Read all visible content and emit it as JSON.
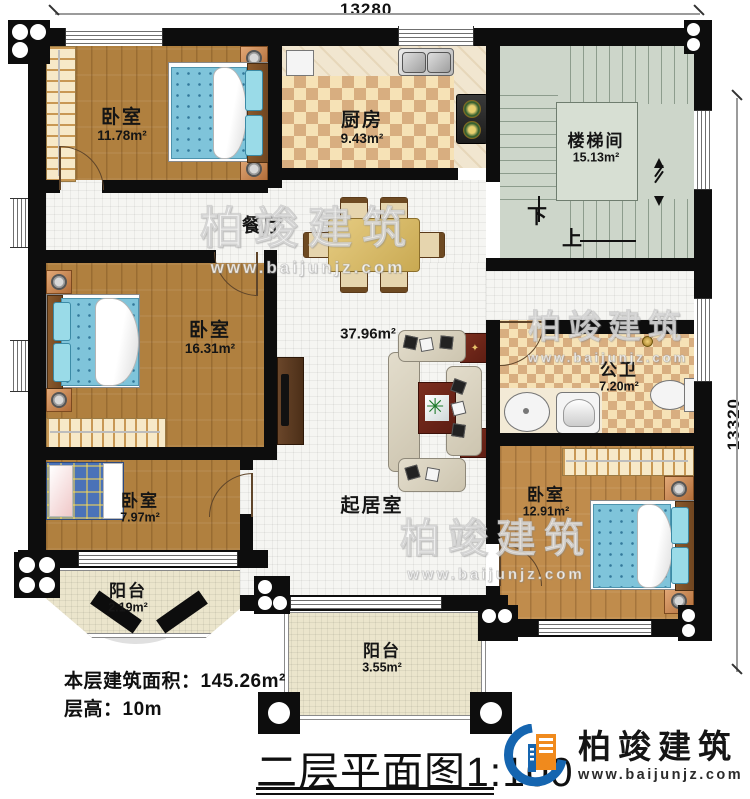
{
  "dimensions": {
    "top": "13280",
    "right": "13320"
  },
  "rooms": {
    "bedroom_top_left": {
      "name": "卧室",
      "area": "11.78m²"
    },
    "kitchen": {
      "name": "厨房",
      "area": "9.43m²"
    },
    "stairwell": {
      "name": "楼梯间",
      "area": "15.13m²"
    },
    "dining": {
      "name": "餐厅"
    },
    "bedroom_mid_left": {
      "name": "卧室",
      "area": "16.31m²"
    },
    "living": {
      "name": "起居室",
      "area": "37.96m²"
    },
    "bathroom": {
      "name": "公卫",
      "area": "7.20m²"
    },
    "bedroom_bottom_left": {
      "name": "卧室",
      "area": "7.97m²"
    },
    "bedroom_bottom_right": {
      "name": "卧室",
      "area": "12.91m²"
    },
    "balcony_left": {
      "name": "阳台",
      "area": "2.19m²"
    },
    "balcony_bottom": {
      "name": "阳台",
      "area": "3.55m²"
    }
  },
  "stairs": {
    "down_label": "下",
    "up_label": "上"
  },
  "notes": {
    "floor_area_label": "本层建筑面积：",
    "floor_area_value": "145.26m²",
    "floor_height_label": "层高：",
    "floor_height_value": "10m"
  },
  "title": {
    "text": "二层平面图",
    "scale": "1:100"
  },
  "branding": {
    "company": "柏竣建筑",
    "website": "www.baijunjz.com"
  },
  "colors": {
    "wall": "#0d0d0d",
    "logo_blue": "#1565b0",
    "logo_orange": "#f08a1d"
  }
}
